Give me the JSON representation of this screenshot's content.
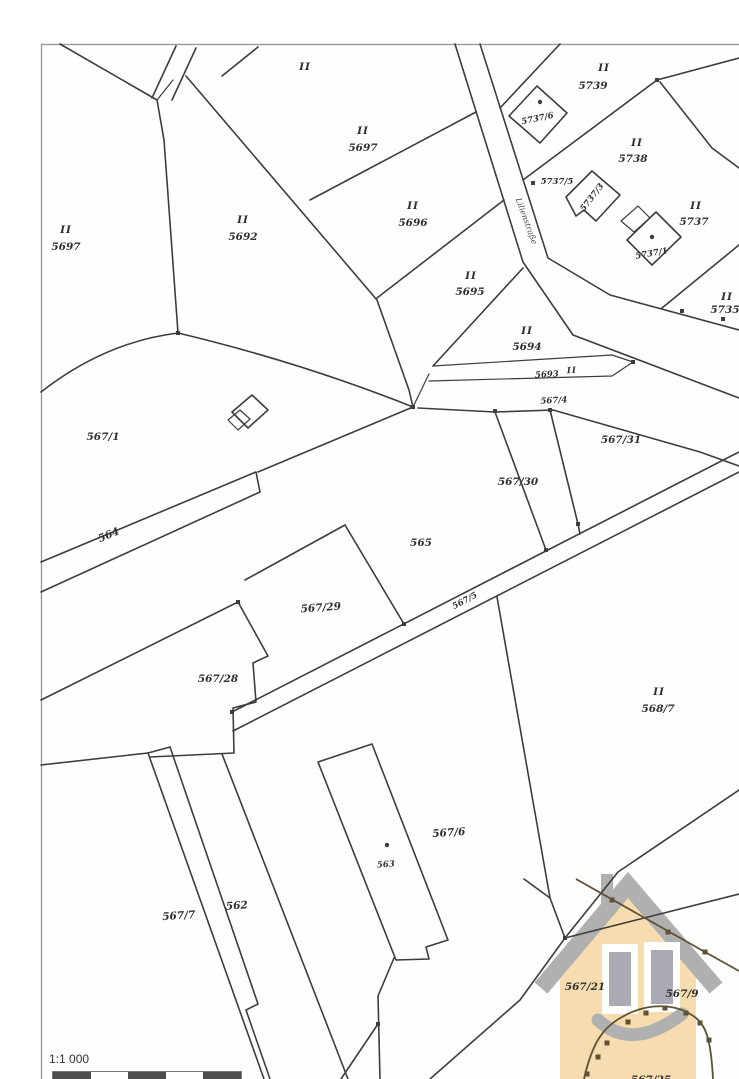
{
  "map": {
    "scale_text": "1:1 000",
    "street_name": "Lilienstraße",
    "colors": {
      "line": "#3d3d3d",
      "house_body": "#f6dcae",
      "house_gray": "#b0b0b0",
      "window_fill": "#a9aab4",
      "survey_brown": "#5d5236",
      "paper": "#ffffff"
    },
    "labels": [
      {
        "text": "II",
        "x": 66,
        "y": 233,
        "r": 0,
        "k": "class"
      },
      {
        "text": "5697",
        "x": 66,
        "y": 250,
        "r": 0,
        "k": "parcel"
      },
      {
        "text": "II",
        "x": 305,
        "y": 70,
        "r": 0,
        "k": "class"
      },
      {
        "text": "II",
        "x": 243,
        "y": 223,
        "r": 0,
        "k": "class"
      },
      {
        "text": "5692",
        "x": 243,
        "y": 240,
        "r": 0,
        "k": "parcel"
      },
      {
        "text": "II",
        "x": 363,
        "y": 134,
        "r": 0,
        "k": "class"
      },
      {
        "text": "5697",
        "x": 363,
        "y": 151,
        "r": 0,
        "k": "parcel"
      },
      {
        "text": "II",
        "x": 413,
        "y": 209,
        "r": 0,
        "k": "class"
      },
      {
        "text": "5696",
        "x": 413,
        "y": 226,
        "r": 0,
        "k": "parcel"
      },
      {
        "text": "II",
        "x": 471,
        "y": 279,
        "r": 0,
        "k": "class"
      },
      {
        "text": "5695",
        "x": 470,
        "y": 295,
        "r": 0,
        "k": "parcel"
      },
      {
        "text": "II",
        "x": 527,
        "y": 334,
        "r": 0,
        "k": "class"
      },
      {
        "text": "5694",
        "x": 527,
        "y": 350,
        "r": 0,
        "k": "parcel"
      },
      {
        "text": "II",
        "x": 604,
        "y": 71,
        "r": 0,
        "k": "class"
      },
      {
        "text": "5739",
        "x": 593,
        "y": 89,
        "r": 0,
        "k": "parcel"
      },
      {
        "text": "5737/6",
        "x": 538,
        "y": 121,
        "r": -12,
        "k": "parcel-sm"
      },
      {
        "text": "5737/5",
        "x": 557,
        "y": 184,
        "r": 0,
        "k": "parcel-sm"
      },
      {
        "text": "II",
        "x": 637,
        "y": 146,
        "r": 0,
        "k": "class"
      },
      {
        "text": "5738",
        "x": 633,
        "y": 162,
        "r": 0,
        "k": "parcel"
      },
      {
        "text": "5737/3",
        "x": 594,
        "y": 199,
        "r": -52,
        "k": "parcel-sm"
      },
      {
        "text": "II",
        "x": 696,
        "y": 209,
        "r": 0,
        "k": "class"
      },
      {
        "text": "5737",
        "x": 694,
        "y": 225,
        "r": 0,
        "k": "parcel"
      },
      {
        "text": "5737/1",
        "x": 652,
        "y": 256,
        "r": -10,
        "k": "parcel-sm"
      },
      {
        "text": "II",
        "x": 727,
        "y": 300,
        "r": 0,
        "k": "class"
      },
      {
        "text": "5735",
        "x": 725,
        "y": 313,
        "r": 0,
        "k": "parcel"
      },
      {
        "text": "Lilienstraße",
        "x": 524,
        "y": 222,
        "r": 70,
        "k": "road-name"
      },
      {
        "text": "5693",
        "x": 547,
        "y": 377,
        "r": -3,
        "k": "parcel-sm"
      },
      {
        "text": "II",
        "x": 572,
        "y": 373,
        "r": -3,
        "k": "class-sm"
      },
      {
        "text": "567/4",
        "x": 554,
        "y": 403,
        "r": -3,
        "k": "parcel-sm"
      },
      {
        "text": "567/1",
        "x": 103,
        "y": 440,
        "r": 0,
        "k": "parcel"
      },
      {
        "text": "567/31",
        "x": 621,
        "y": 443,
        "r": 0,
        "k": "parcel"
      },
      {
        "text": "567/30",
        "x": 518,
        "y": 485,
        "r": 0,
        "k": "parcel"
      },
      {
        "text": "565",
        "x": 421,
        "y": 546,
        "r": 0,
        "k": "parcel"
      },
      {
        "text": "564",
        "x": 110,
        "y": 538,
        "r": -23,
        "k": "parcel"
      },
      {
        "text": "567/29",
        "x": 321,
        "y": 611,
        "r": -4,
        "k": "parcel"
      },
      {
        "text": "567/5",
        "x": 466,
        "y": 603,
        "r": -28,
        "k": "parcel-sm"
      },
      {
        "text": "567/28",
        "x": 218,
        "y": 682,
        "r": 0,
        "k": "parcel"
      },
      {
        "text": "II",
        "x": 659,
        "y": 695,
        "r": 0,
        "k": "class"
      },
      {
        "text": "568/7",
        "x": 658,
        "y": 712,
        "r": 0,
        "k": "parcel"
      },
      {
        "text": "567/6",
        "x": 449,
        "y": 836,
        "r": -4,
        "k": "parcel"
      },
      {
        "text": "563",
        "x": 386,
        "y": 867,
        "r": -4,
        "k": "parcel-sm"
      },
      {
        "text": "562",
        "x": 237,
        "y": 909,
        "r": -4,
        "k": "parcel"
      },
      {
        "text": "567/7",
        "x": 179,
        "y": 919,
        "r": -4,
        "k": "parcel"
      },
      {
        "text": "567/21",
        "x": 585,
        "y": 990,
        "r": 0,
        "k": "parcel"
      },
      {
        "text": "567/9",
        "x": 682,
        "y": 997,
        "r": 0,
        "k": "parcel"
      },
      {
        "text": "567/25",
        "x": 651,
        "y": 1083,
        "r": 0,
        "k": "parcel"
      }
    ],
    "boundary_markers": [
      [
        495,
        411
      ],
      [
        633,
        362
      ],
      [
        404,
        624
      ],
      [
        238,
        602
      ],
      [
        565,
        938
      ],
      [
        378,
        1024
      ],
      [
        657,
        80
      ],
      [
        533,
        183
      ],
      [
        682,
        311
      ],
      [
        723,
        319
      ],
      [
        413,
        407
      ],
      [
        178,
        333
      ],
      [
        550,
        410
      ],
      [
        578,
        524
      ],
      [
        546,
        550
      ],
      [
        232,
        712
      ]
    ],
    "survey_markers": [
      [
        612,
        900
      ],
      [
        668,
        932
      ],
      [
        705,
        952
      ],
      [
        587,
        1074
      ],
      [
        598,
        1057
      ],
      [
        607,
        1043
      ],
      [
        628,
        1022
      ],
      [
        646,
        1013
      ],
      [
        665,
        1008
      ],
      [
        686,
        1013
      ],
      [
        700,
        1023
      ],
      [
        709,
        1040
      ]
    ],
    "building_dots": [
      [
        540,
        102
      ],
      [
        652,
        237
      ],
      [
        387,
        845
      ]
    ]
  }
}
